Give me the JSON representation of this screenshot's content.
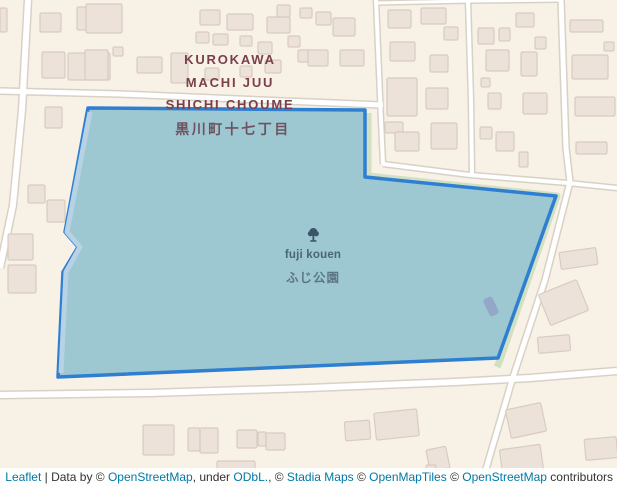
{
  "district_label": {
    "line1": "KUROKAWA",
    "line2": "MACHI JUU",
    "line3": "SHICHI CHOUME",
    "japanese": "黒川町十七丁目"
  },
  "park_label": {
    "name_en": "fuji kouen",
    "name_jp": "ふじ公園",
    "icon": "tree-icon"
  },
  "attribution": {
    "leaflet": "Leaflet",
    "sep": " | ",
    "data_by": "Data by © ",
    "osm": "OpenStreetMap",
    "under": ", under ",
    "odbl": "ODbL.",
    "comma_c": ", © ",
    "stadia": "Stadia Maps",
    "c1": " © ",
    "openmaptiles": "OpenMapTiles",
    "c2": " © ",
    "osm2": "OpenStreetMap",
    "contributors": " contributors"
  },
  "colors": {
    "land": "#f8f1e6",
    "road_casing": "#d8d1c6",
    "road_core": "#ffffff",
    "building_fill": "#ece2d9",
    "building_outline": "#d8ccc1",
    "park_green": "#d1e0c2",
    "overlay_fill": "#9dc8d1",
    "overlay_stroke": "#2e7fd1",
    "inner_path": "#b6d2e4",
    "poi_fill": "#92a8c6",
    "label_maroon": "#7b3f4b",
    "park_text": "#4a6479",
    "tree_icon": "#3a5468",
    "link_blue": "#0078a8"
  },
  "geometry": {
    "park_polygon": [
      [
        88,
        108
      ],
      [
        365,
        110
      ],
      [
        365,
        177
      ],
      [
        556,
        196
      ],
      [
        498,
        358
      ],
      [
        58,
        377
      ],
      [
        63,
        272
      ],
      [
        78,
        247
      ],
      [
        65,
        232
      ]
    ],
    "green_strip": [
      [
        368,
        113
      ],
      [
        368,
        176
      ],
      [
        557,
        196
      ],
      [
        500,
        360
      ],
      [
        497,
        367
      ]
    ],
    "inner_strip": [
      [
        90,
        112
      ],
      [
        67,
        232
      ],
      [
        80,
        247
      ],
      [
        66,
        272
      ],
      [
        61,
        373
      ]
    ],
    "poi_rect": {
      "x": 486,
      "y": 297,
      "w": 10,
      "h": 19,
      "r": -25
    },
    "roads": [
      {
        "pts": [
          [
            28,
            0
          ],
          [
            22,
            110
          ],
          [
            13,
            205
          ],
          [
            0,
            268
          ]
        ],
        "w": 9
      },
      {
        "pts": [
          [
            0,
            91
          ],
          [
            120,
            94
          ],
          [
            260,
            100
          ],
          [
            383,
            105
          ]
        ],
        "w": 8
      },
      {
        "pts": [
          [
            376,
            3
          ],
          [
            470,
            1
          ],
          [
            560,
            0
          ]
        ],
        "w": 6
      },
      {
        "pts": [
          [
            376,
            0
          ],
          [
            381,
            120
          ],
          [
            383,
            164
          ]
        ],
        "w": 7
      },
      {
        "pts": [
          [
            468,
            0
          ],
          [
            471,
            100
          ],
          [
            472,
            174
          ]
        ],
        "w": 7
      },
      {
        "pts": [
          [
            383,
            164
          ],
          [
            470,
            175
          ],
          [
            568,
            183
          ],
          [
            617,
            188
          ]
        ],
        "w": 7
      },
      {
        "pts": [
          [
            561,
            0
          ],
          [
            566,
            148
          ],
          [
            570,
            182
          ],
          [
            545,
            280
          ],
          [
            513,
            377
          ],
          [
            481,
            486
          ]
        ],
        "w": 8
      },
      {
        "pts": [
          [
            0,
            395
          ],
          [
            150,
            393
          ],
          [
            308,
            388
          ],
          [
            455,
            382
          ],
          [
            530,
            378
          ],
          [
            617,
            371
          ]
        ],
        "w": 9
      }
    ],
    "buildings": [
      [
        0,
        8,
        7,
        24,
        0
      ],
      [
        40,
        13,
        21,
        19,
        0
      ],
      [
        77,
        7,
        33,
        23,
        0
      ],
      [
        86,
        4,
        36,
        29,
        0
      ],
      [
        42,
        52,
        23,
        26,
        0
      ],
      [
        68,
        53,
        42,
        27,
        0
      ],
      [
        85,
        50,
        23,
        30,
        0
      ],
      [
        113,
        47,
        10,
        9,
        0
      ],
      [
        137,
        57,
        25,
        16,
        0
      ],
      [
        171,
        53,
        17,
        30,
        0
      ],
      [
        45,
        107,
        17,
        21,
        0
      ],
      [
        28,
        185,
        17,
        18,
        0
      ],
      [
        47,
        200,
        18,
        22,
        0
      ],
      [
        8,
        234,
        25,
        26,
        0
      ],
      [
        8,
        265,
        28,
        28,
        0
      ],
      [
        200,
        10,
        20,
        15,
        0
      ],
      [
        227,
        14,
        26,
        16,
        0
      ],
      [
        267,
        17,
        23,
        16,
        0
      ],
      [
        277,
        5,
        13,
        12,
        0
      ],
      [
        196,
        32,
        13,
        11,
        0
      ],
      [
        213,
        34,
        15,
        11,
        0
      ],
      [
        240,
        36,
        12,
        10,
        0
      ],
      [
        258,
        42,
        14,
        12,
        0
      ],
      [
        288,
        36,
        12,
        11,
        0
      ],
      [
        298,
        50,
        14,
        12,
        0
      ],
      [
        265,
        60,
        16,
        13,
        0
      ],
      [
        240,
        66,
        12,
        11,
        0
      ],
      [
        205,
        68,
        14,
        12,
        0
      ],
      [
        300,
        8,
        12,
        10,
        0
      ],
      [
        316,
        12,
        15,
        13,
        0
      ],
      [
        333,
        18,
        22,
        18,
        0
      ],
      [
        308,
        50,
        20,
        16,
        0
      ],
      [
        340,
        50,
        24,
        16,
        0
      ],
      [
        388,
        10,
        23,
        18,
        0
      ],
      [
        421,
        8,
        25,
        16,
        0
      ],
      [
        444,
        27,
        14,
        13,
        0
      ],
      [
        390,
        42,
        25,
        19,
        0
      ],
      [
        430,
        55,
        18,
        17,
        0
      ],
      [
        387,
        78,
        30,
        38,
        0
      ],
      [
        426,
        88,
        22,
        21,
        0
      ],
      [
        385,
        122,
        18,
        11,
        0
      ],
      [
        395,
        132,
        24,
        19,
        0
      ],
      [
        431,
        123,
        26,
        26,
        0
      ],
      [
        478,
        28,
        16,
        16,
        0
      ],
      [
        499,
        28,
        11,
        13,
        0
      ],
      [
        516,
        13,
        18,
        14,
        0
      ],
      [
        486,
        50,
        23,
        21,
        0
      ],
      [
        521,
        52,
        16,
        24,
        0
      ],
      [
        535,
        37,
        11,
        12,
        0
      ],
      [
        481,
        78,
        9,
        9,
        0
      ],
      [
        488,
        93,
        13,
        16,
        0
      ],
      [
        523,
        93,
        24,
        21,
        0
      ],
      [
        480,
        127,
        12,
        12,
        0
      ],
      [
        496,
        132,
        18,
        19,
        0
      ],
      [
        519,
        152,
        9,
        15,
        0
      ],
      [
        570,
        20,
        33,
        12,
        0
      ],
      [
        572,
        55,
        36,
        24,
        0
      ],
      [
        575,
        97,
        40,
        19,
        0
      ],
      [
        576,
        142,
        31,
        12,
        0
      ],
      [
        604,
        42,
        10,
        9,
        0
      ],
      [
        560,
        250,
        37,
        17,
        -8
      ],
      [
        543,
        286,
        41,
        33,
        -22
      ],
      [
        538,
        336,
        32,
        16,
        -5
      ],
      [
        508,
        406,
        36,
        29,
        -12
      ],
      [
        501,
        447,
        41,
        26,
        -8
      ],
      [
        585,
        438,
        32,
        21,
        -5
      ],
      [
        143,
        425,
        31,
        30,
        0
      ],
      [
        188,
        428,
        12,
        23,
        0
      ],
      [
        200,
        428,
        18,
        25,
        0
      ],
      [
        237,
        430,
        20,
        18,
        0
      ],
      [
        258,
        432,
        8,
        14,
        0
      ],
      [
        266,
        433,
        19,
        17,
        0
      ],
      [
        217,
        461,
        38,
        25,
        0
      ],
      [
        345,
        421,
        25,
        19,
        -4
      ],
      [
        375,
        411,
        43,
        27,
        -6
      ],
      [
        428,
        448,
        20,
        22,
        -12
      ],
      [
        426,
        465,
        10,
        11,
        0
      ]
    ]
  }
}
